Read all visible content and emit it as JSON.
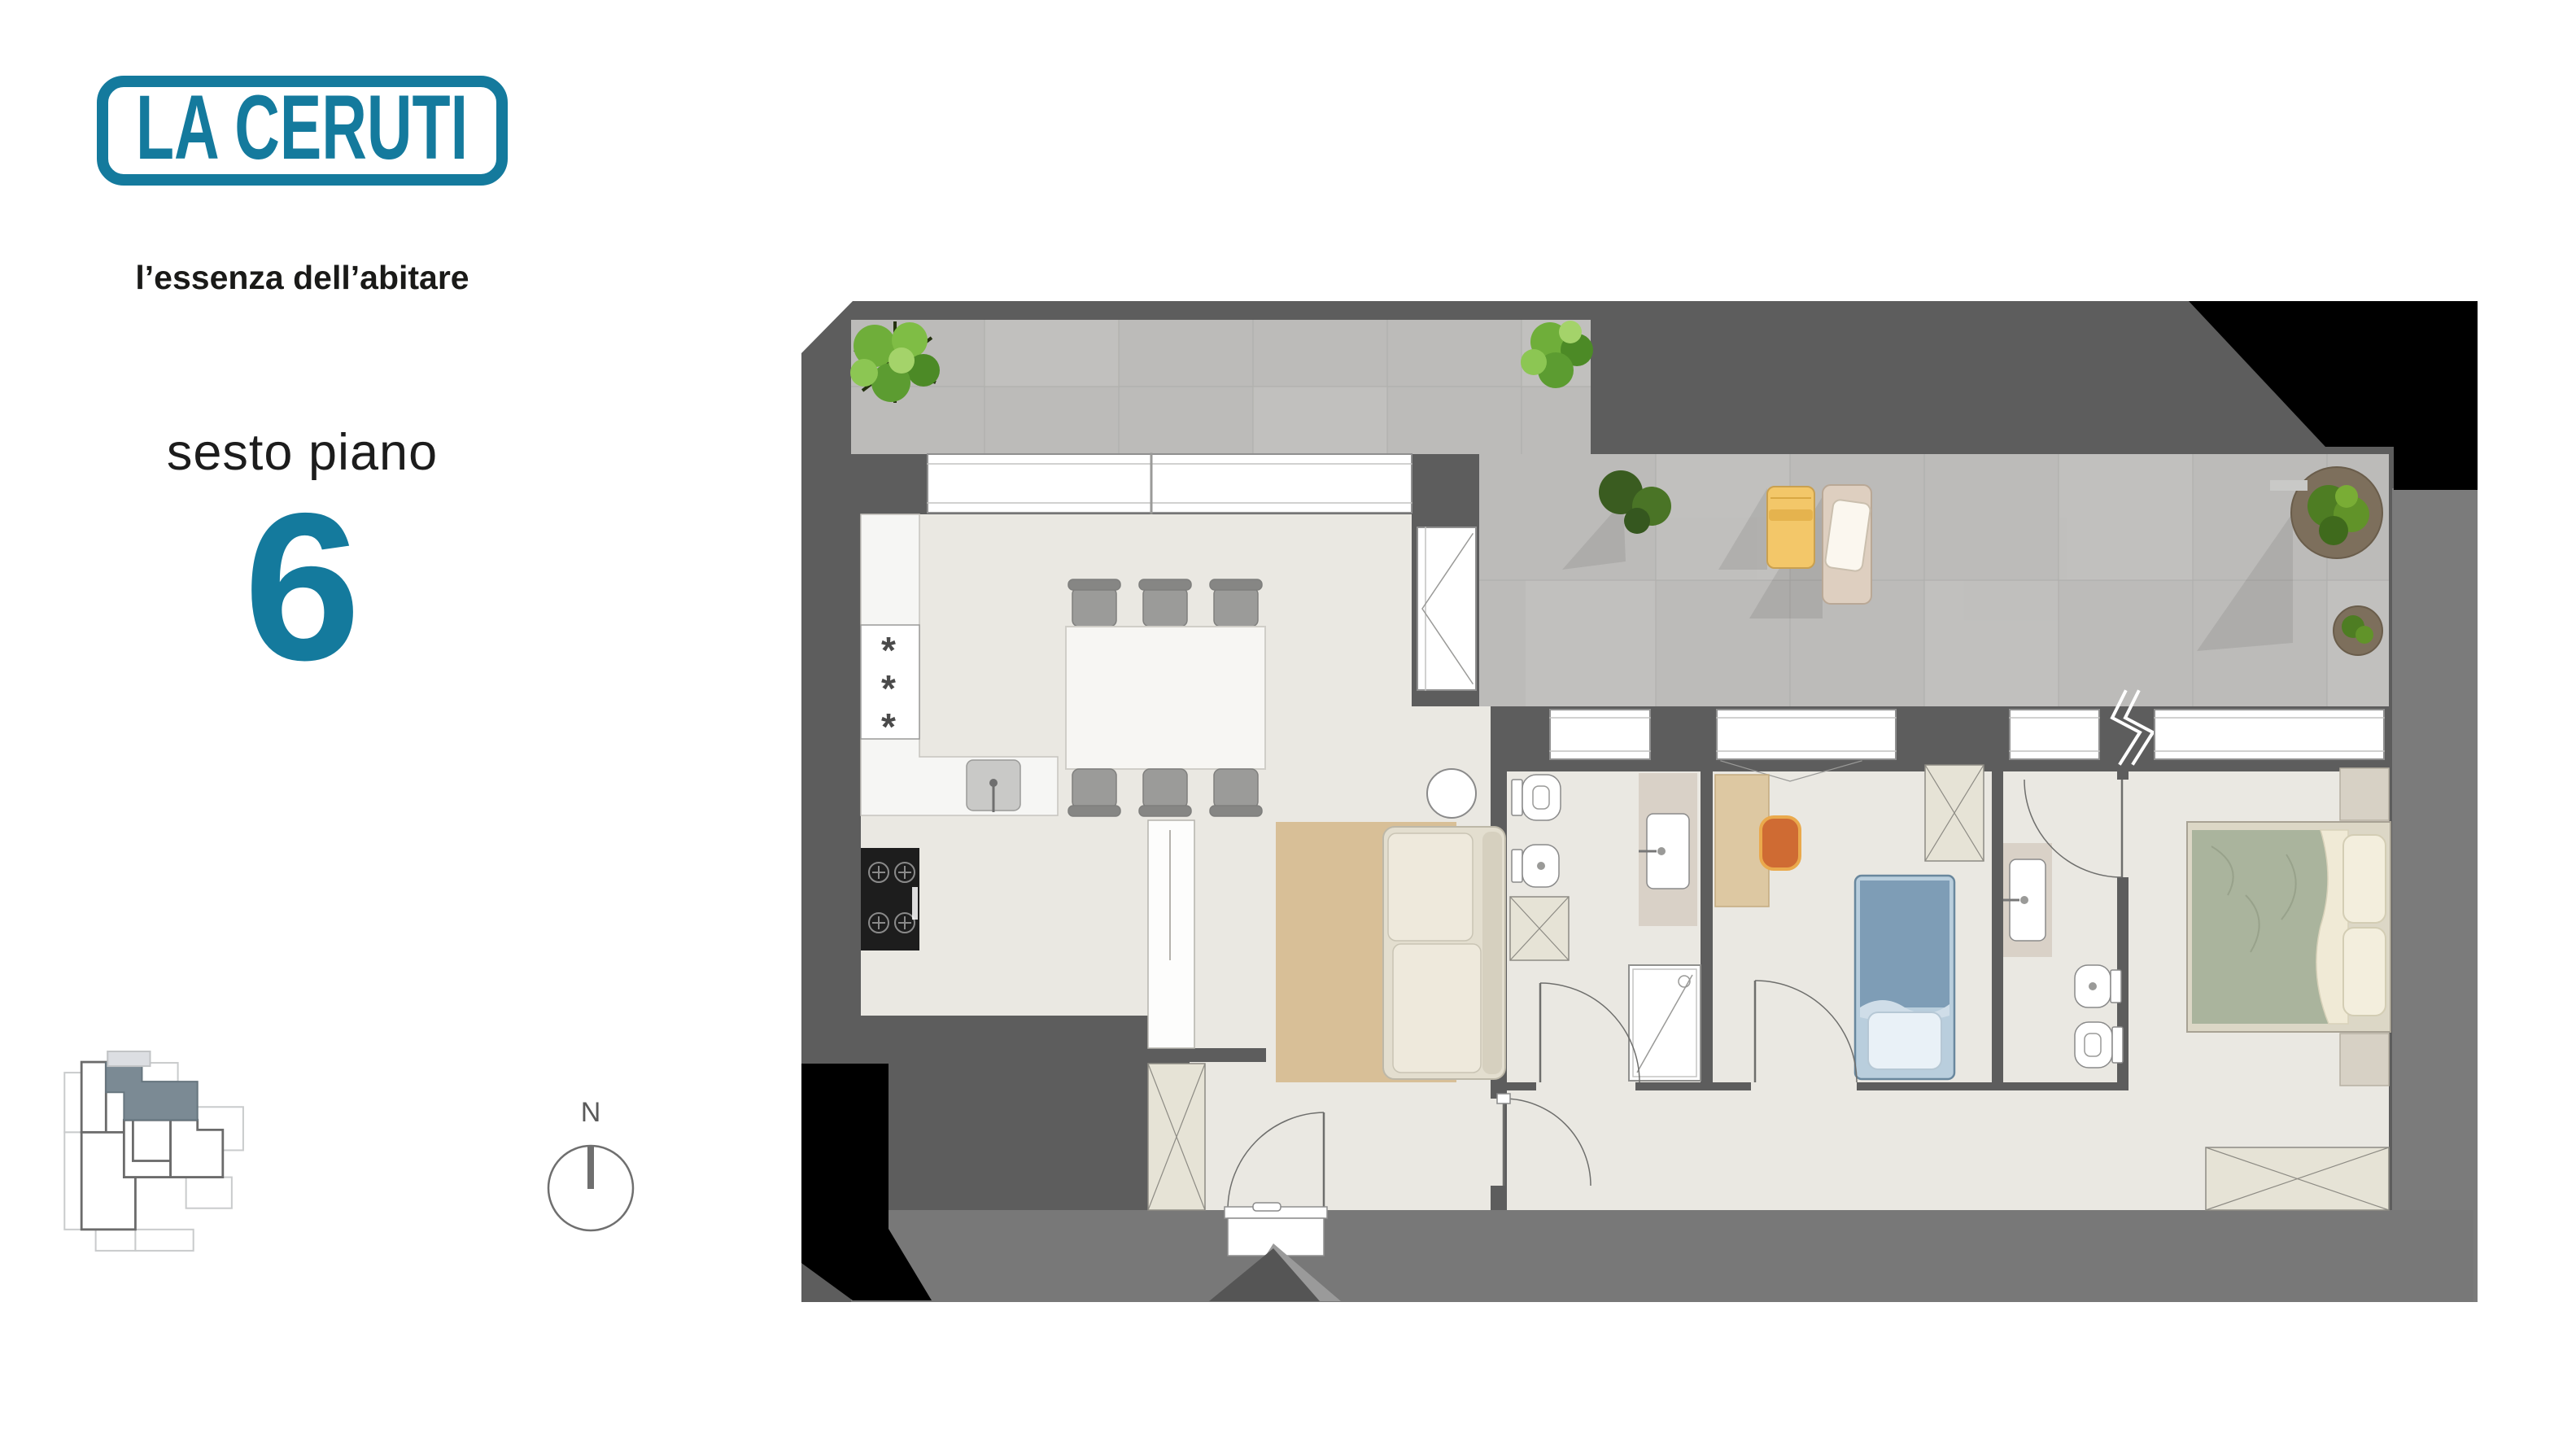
{
  "branding": {
    "logo_text": "LA CERUTI",
    "tagline": "l’essenza dell’abitare",
    "brand_color": "#147a9d",
    "tagline_color": "#1a1a18"
  },
  "floor": {
    "label": "sesto piano",
    "number": "6",
    "number_color": "#147a9d"
  },
  "compass": {
    "north_label": "N"
  },
  "key_plan": {
    "highlight_color": "#7b8a94",
    "secondary_highlight_color": "#dcdee2",
    "outline_dark": "#6b6b6b",
    "outline_light": "#c9cbcc"
  },
  "plan_colors": {
    "surround_dark": "#5d5d5d",
    "surround_light": "#7b7b7b",
    "corner_shadow": "#000000",
    "terrace_stone": "#bcbbb9",
    "interior_floor": "#eae8e2",
    "fixture_white": "#ffffff",
    "wardrobe_fill": "#e6e3d6",
    "rug": "#d8bf97",
    "sofa": "#e3decf",
    "double_bed": "#aab49d",
    "single_bed": "#7e9db6",
    "lounger_yellow": "#f3c769",
    "lounger_beige": "#decfc0",
    "desk_wood": "#ddc8a2",
    "chair_accent": "#cf6b33",
    "greenery": "#5c9c31",
    "counter_greige": "#d9d1c7"
  }
}
